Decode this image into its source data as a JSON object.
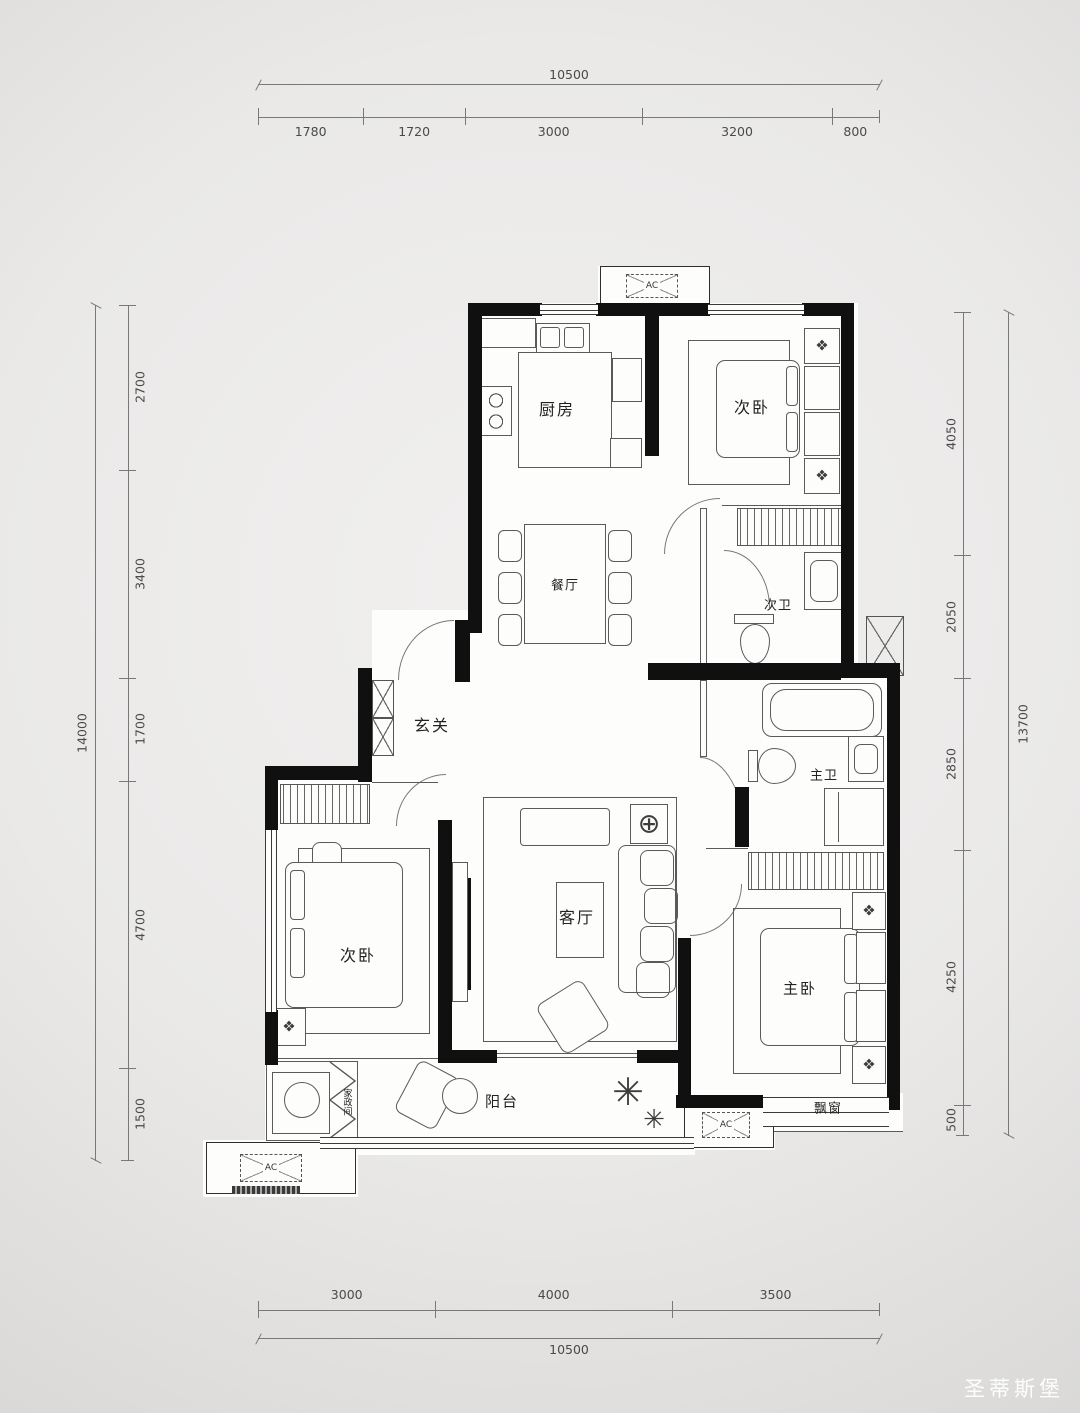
{
  "watermark": "圣蒂斯堡",
  "icons": {
    "lamp": "❖",
    "plant": "✳",
    "light": "⊕"
  },
  "rooms": {
    "kitchen": "厨房",
    "bedroom_top": "次卧",
    "dining": "餐厅",
    "bath_second": "次卫",
    "foyer": "玄关",
    "living": "客厅",
    "bedroom_left": "次卧",
    "bath_master": "主卫",
    "bedroom_master": "主卧",
    "balcony": "阳台",
    "bay_window": "飘窗",
    "laundry": "家政间",
    "ac": "AC"
  },
  "dimensions": {
    "top": {
      "total": "10500",
      "segments": [
        "1780",
        "1720",
        "3000",
        "3200",
        "800"
      ]
    },
    "bottom": {
      "total": "10500",
      "segments": [
        "3000",
        "4000",
        "3500"
      ]
    },
    "left": {
      "total": "14000",
      "segments": [
        "2700",
        "3400",
        "1700",
        "4700",
        "1500"
      ]
    },
    "right": {
      "total": "13700",
      "segments": [
        "4050",
        "2050",
        "2850",
        "4250",
        "500"
      ]
    }
  }
}
